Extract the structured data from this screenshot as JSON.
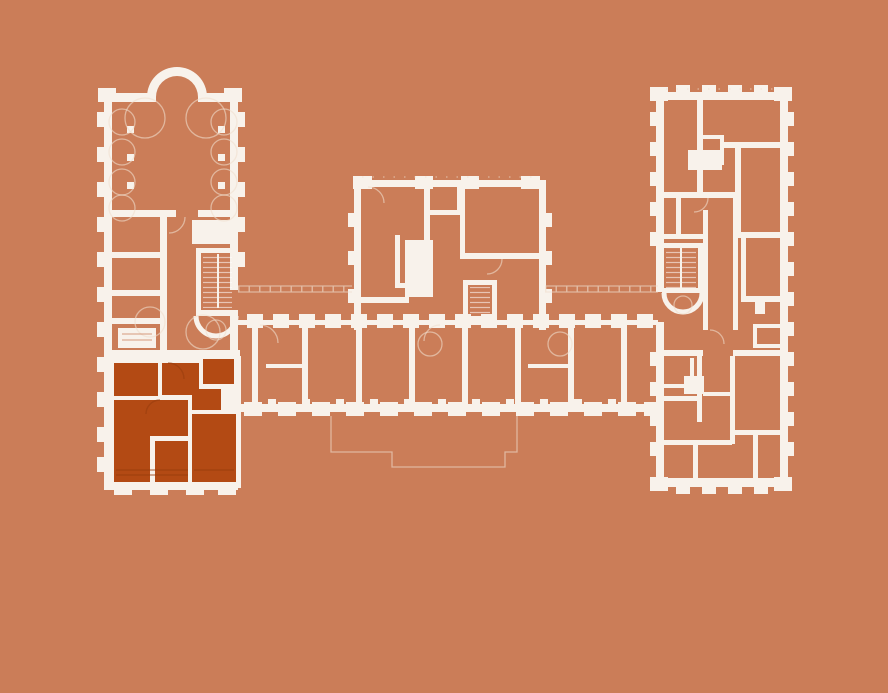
{
  "colors": {
    "background": "#cb7d58",
    "wall": "#f8f2eb",
    "faint": "#f0ddcd",
    "highlight": "#b34a14",
    "highlight_line": "#953d0c"
  },
  "plan": {
    "name": "building-floor-plan",
    "sections": [
      {
        "id": "west-wing",
        "highlighted": false
      },
      {
        "id": "central-pavilion",
        "highlighted": false
      },
      {
        "id": "south-corridor-range",
        "highlighted": false
      },
      {
        "id": "east-wing",
        "highlighted": false
      },
      {
        "id": "highlighted-apartment",
        "highlighted": true
      }
    ],
    "highlighted_room_count": 6
  }
}
